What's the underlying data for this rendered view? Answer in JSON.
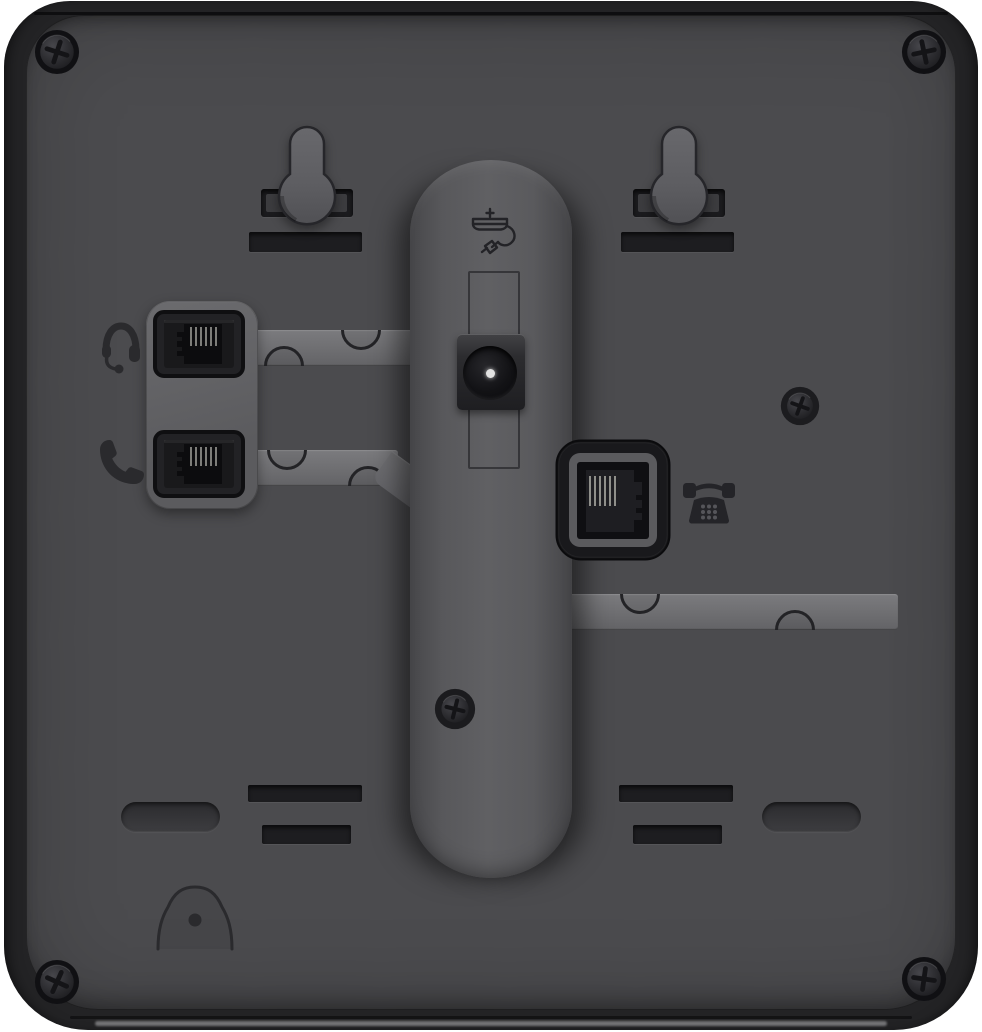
{
  "meta": {
    "type": "product-photo",
    "subject": "Rear view of a black desk IP phone back panel",
    "width_px": 982,
    "height_px": 1032
  },
  "palette": {
    "background": "#ffffff",
    "shell": "#232325",
    "panel": "#4b4b4e",
    "raised_molding": "#616164",
    "recess": "#1b1b1e",
    "contact_pins": "#9a9a94",
    "power_pin": "#e2e2e2"
  },
  "components": {
    "phone_back": {
      "label": "Desk phone rear housing"
    },
    "back_panel": {
      "label": "Recessed back panel"
    },
    "wall_mount_left": {
      "label": "Left wall-mount keyhole slot"
    },
    "wall_mount_right": {
      "label": "Right wall-mount keyhole slot"
    },
    "headset_port": {
      "label": "Headset jack (RJ9)",
      "icon": "headset-icon"
    },
    "handset_port": {
      "label": "Handset jack (RJ9)",
      "icon": "handset-icon"
    },
    "power_jack": {
      "label": "DC power input",
      "icon": "power-adapter-icon"
    },
    "line_port": {
      "label": "Telephone line jack (RJ11)",
      "icon": "phone-icon"
    },
    "stand_column": {
      "label": "Stand mounting channel"
    },
    "cable_channel_headset": {
      "label": "Headset cable routing channel"
    },
    "cable_channel_handset": {
      "label": "Handset cable routing channel"
    },
    "cable_channel_line": {
      "label": "Line cable routing channel"
    },
    "wall_hook_emboss": {
      "label": "Handset wall-hook emboss"
    },
    "foot_recess": {
      "label": "Foot recess"
    },
    "vent_slot": {
      "label": "Vent slot"
    },
    "screw": {
      "label": "Phillips screw"
    }
  },
  "counts": {
    "corner_screws": 4,
    "panel_screws": 2,
    "modular_jacks": 3,
    "vent_slots": 4,
    "foot_recesses": 2,
    "wall_mount_keyholes": 2
  }
}
